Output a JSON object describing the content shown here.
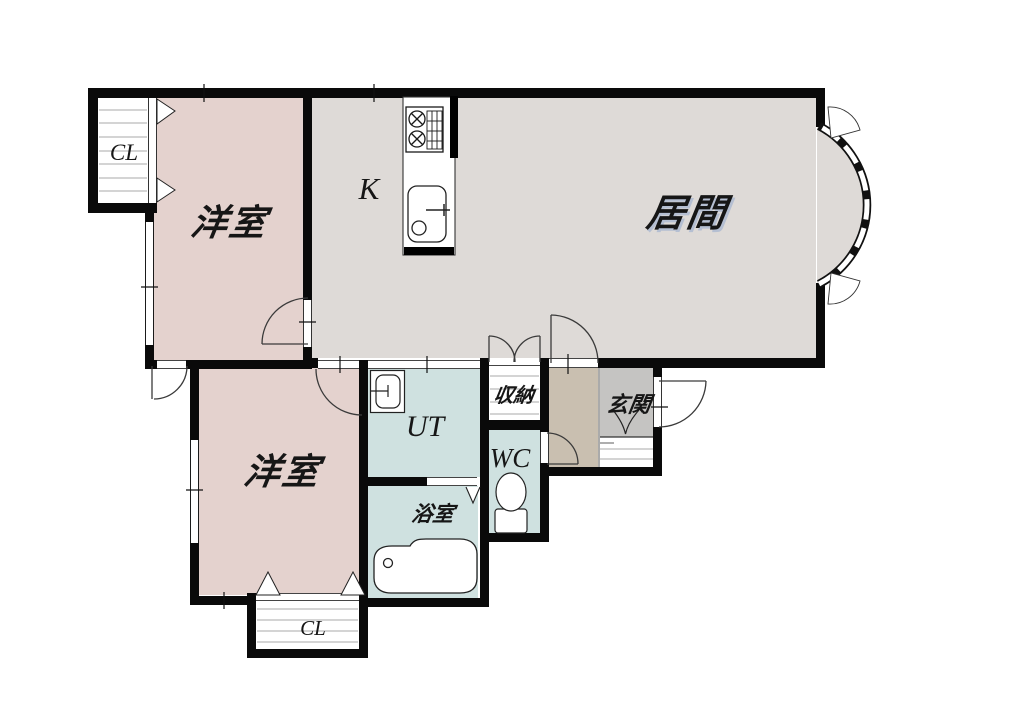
{
  "plan": {
    "type": "apartment-floor-plan",
    "rooms": {
      "closet_top": {
        "label": "CL"
      },
      "bedroom_top": {
        "label": "洋室"
      },
      "kitchen": {
        "label": "K"
      },
      "living": {
        "label": "居間"
      },
      "bedroom_bottom": {
        "label": "洋室"
      },
      "utility": {
        "label": "UT"
      },
      "storage": {
        "label": "収納"
      },
      "entrance": {
        "label": "玄関"
      },
      "toilet": {
        "label": "WC"
      },
      "bathroom": {
        "label": "浴室"
      },
      "closet_bottom": {
        "label": "CL"
      }
    },
    "colors": {
      "bedroom_floor": "#e4d2ce",
      "living_floor": "#dedad7",
      "wet_area_floor": "#cfe1e0",
      "hall_floor": "#c9bfb0",
      "entrance_floor": "#c5c4c2",
      "wall": "#0a0a0a"
    },
    "icons": [
      "stove-icon",
      "sink-icon",
      "washer-icon",
      "bathtub-icon",
      "toilet-icon",
      "bay-window",
      "door-swing-arc",
      "bifold-door-triangle",
      "entrance-step-mark"
    ]
  }
}
